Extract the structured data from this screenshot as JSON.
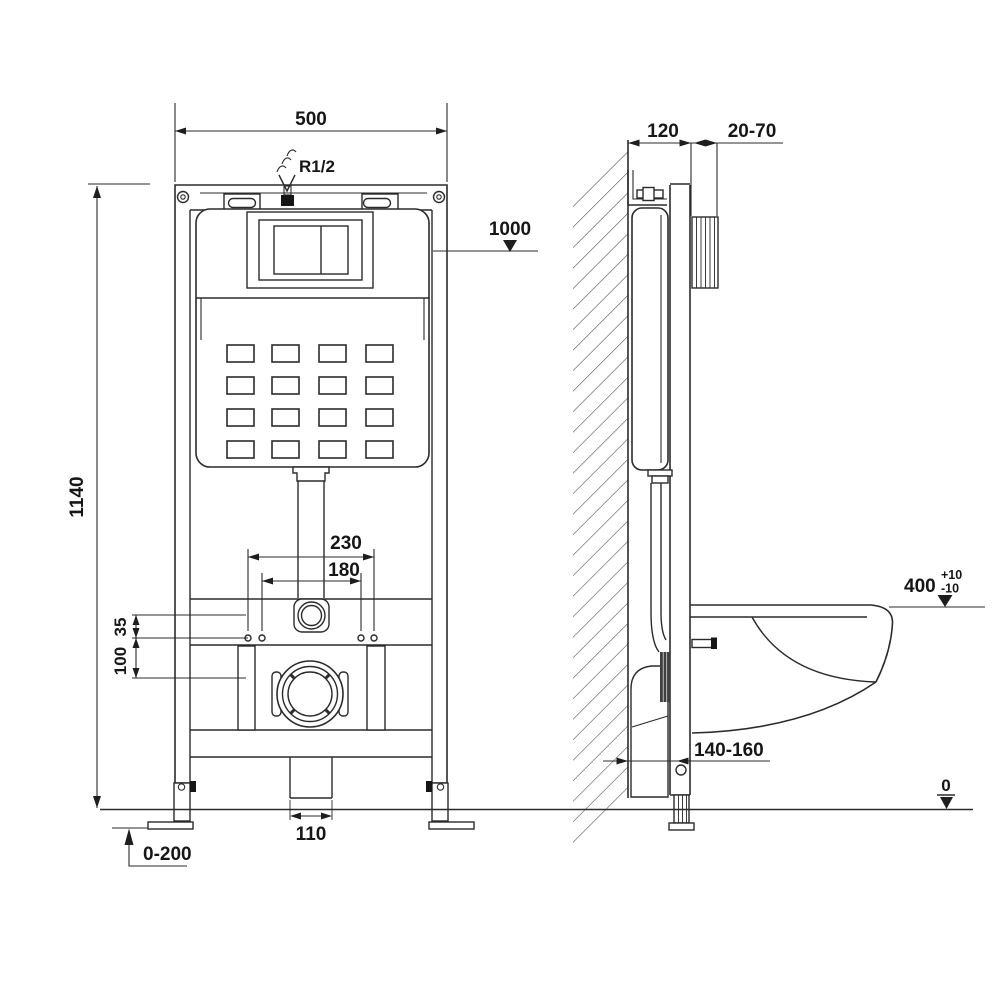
{
  "drawing": {
    "labels": {
      "front": {
        "width": "500",
        "inlet": "R1/2",
        "flush_level": "1000",
        "height": "1140",
        "bolt_outer": "230",
        "bolt_inner": "180",
        "offset_a": "35",
        "offset_b": "100",
        "drain_width": "110",
        "foot_range": "0-200"
      },
      "side": {
        "depth": "120",
        "front_range": "20-70",
        "rim_height": "400",
        "tol_plus": "+10",
        "tol_minus": "-10",
        "outlet_range": "140-160",
        "floor": "0"
      }
    },
    "line_color": "#2b2b2b",
    "background": "#ffffff"
  }
}
